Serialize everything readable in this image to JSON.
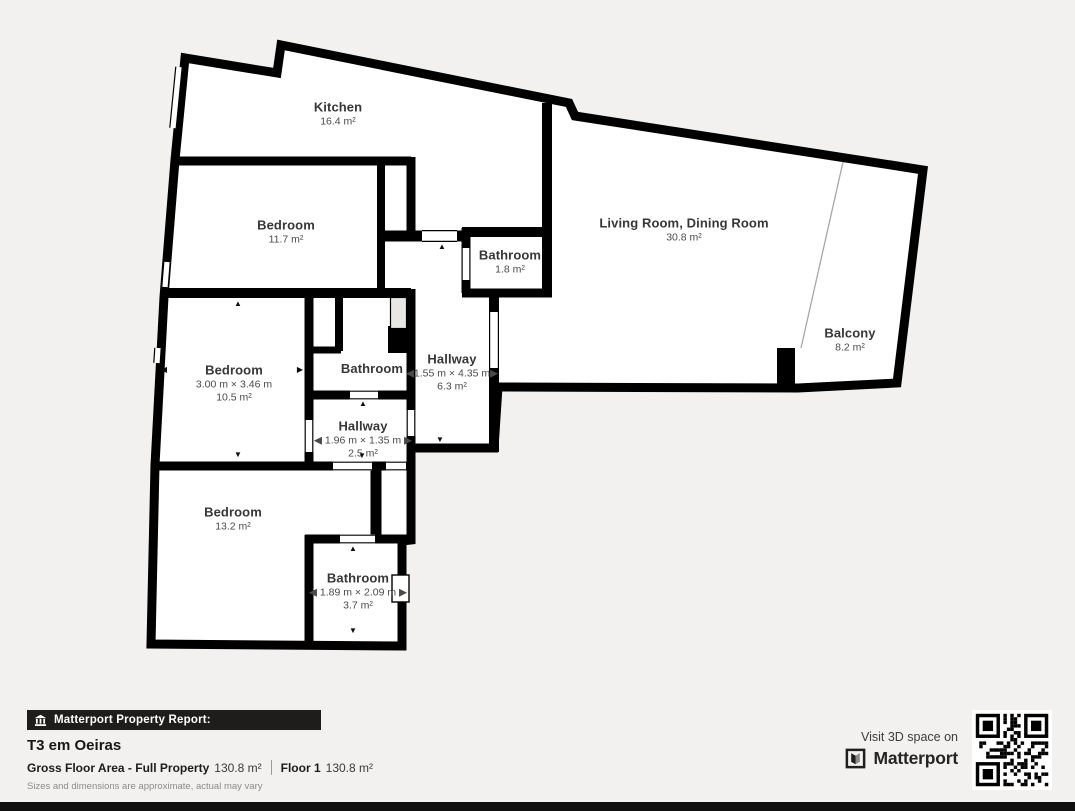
{
  "glyphs": {
    "up": "▲",
    "down": "▼",
    "left": "◀",
    "right": "▶"
  },
  "rooms": {
    "kitchen": {
      "name": "Kitchen",
      "area": "16.4 m²"
    },
    "bedroom1": {
      "name": "Bedroom",
      "area": "11.7 m²"
    },
    "living": {
      "name": "Living Room, Dining Room",
      "area": "30.8 m²"
    },
    "bathroom_top": {
      "name": "Bathroom",
      "area": "1.8 m²"
    },
    "bedroom2": {
      "name": "Bedroom",
      "dims": "3.00 m × 3.46 m",
      "area": "10.5 m²"
    },
    "bathroom_mid": {
      "name": "Bathroom"
    },
    "hallway_main": {
      "name": "Hallway",
      "dims": "◀1.55 m × 4.35 m▶",
      "area": "6.3 m²"
    },
    "hallway_small": {
      "name": "Hallway",
      "dims": "◀ 1.96 m × 1.35 m ▶",
      "area": "2.5 m²"
    },
    "bedroom3": {
      "name": "Bedroom",
      "area": "13.2 m²"
    },
    "bathroom_bottom": {
      "name": "Bathroom",
      "dims": "◀ 1.89 m × 2.09 m ▶",
      "area": "3.7 m²"
    },
    "balcony": {
      "name": "Balcony",
      "area": "8.2 m²"
    }
  },
  "report": {
    "badge": "Matterport Property Report:",
    "title": "T3 em Oeiras",
    "gfa_label": "Gross Floor Area - Full Property",
    "gfa_value": "130.8 m²",
    "floor_label": "Floor 1",
    "floor_value": "130.8 m²",
    "disclaimer": "Sizes and dimensions are approximate, actual may vary"
  },
  "cta": {
    "text": "Visit 3D space on",
    "brand": "Matterport"
  },
  "colors": {
    "wall": "#000000",
    "background": "#f3f1ef",
    "room_fill": "#ffffff",
    "shaft_fill": "#e9e7e4",
    "badge_bg": "#1d1d1b",
    "bottom_strip": "#0f0f0f"
  }
}
